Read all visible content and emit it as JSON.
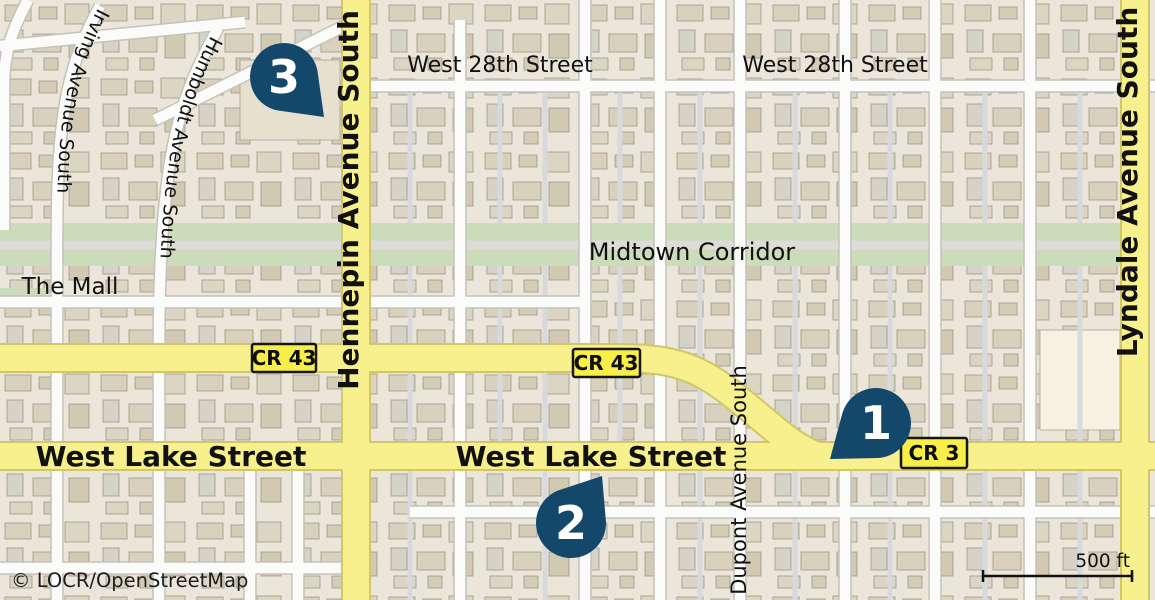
{
  "map": {
    "attribution": "© LOCR/OpenStreetMap",
    "scale_bar": {
      "label": "500 ft"
    },
    "labels": {
      "west_28th_a": "West 28th Street",
      "west_28th_b": "West 28th Street",
      "midtown_corridor": "Midtown Corridor",
      "the_mall": "The Mall",
      "west_lake_a": "West Lake Street",
      "west_lake_b": "West Lake Street",
      "hennepin": "Hennepin Avenue South",
      "lyndale": "Lyndale Avenue South",
      "humboldt": "Humboldt Avenue South",
      "irving": "Irving Avenue South",
      "dupont": "Dupont Avenue South"
    },
    "shields": [
      {
        "label": "CR 43"
      },
      {
        "label": "CR 43"
      },
      {
        "label": "CR 3"
      }
    ],
    "markers": [
      {
        "label": "1"
      },
      {
        "label": "2"
      },
      {
        "label": "3"
      }
    ],
    "colors": {
      "marker": "#14486b",
      "road_highlight": "#f7f08c",
      "road_casing": "#d2c766",
      "shield_fill": "#f8ee4a",
      "greenway": "#cbdcba",
      "block": "#ebe6d9",
      "building": "#d8d0bc",
      "street": "#fbfbf9"
    }
  }
}
